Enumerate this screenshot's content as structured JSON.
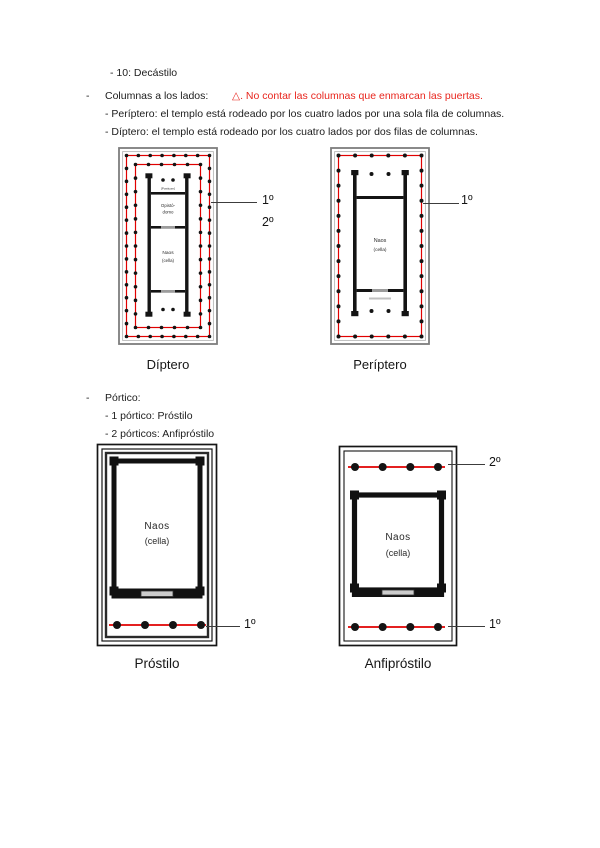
{
  "colors": {
    "warning_red": "#e8251d",
    "diagram_red": "#e10000",
    "ink": "#1c1c1c"
  },
  "notes": {
    "line1": "- 10: Decástilo",
    "bullet": "-",
    "columns_label": "Columnas a los lados:",
    "warning": "△. No contar las columnas que enmarcan las puertas.",
    "periptero_def": "- Períptero: el templo está rodeado por los cuatro lados por una sola fila de columnas.",
    "diptero_def": "- Díptero: el templo está rodeado por los cuatro lados por dos filas de columnas."
  },
  "portico": {
    "bullet": "-",
    "title": "Pórtico:",
    "item1": "- 1 pórtico: Próstilo",
    "item2": "- 2 pórticos: Anfipróstilo"
  },
  "diagrams": {
    "diptero": {
      "caption": "Díptero",
      "posticum_label": "[Posticum]",
      "opistodomo_line1": "Opistó-",
      "opistodomo_line2": "domo",
      "naos_line1": "Naos",
      "naos_line2": "(cella)",
      "annotation_1": "1º",
      "annotation_2": "2º",
      "outer_short_side_columns": 8,
      "outer_long_side_columns": 15,
      "inner_short_side_columns": 6,
      "inner_long_side_columns": 13,
      "porch_columns": 2
    },
    "periptero": {
      "caption": "Períptero",
      "naos_line1": "Naos",
      "naos_line2": "(cella)",
      "annotation_1": "1º",
      "short_side_columns": 6,
      "long_side_columns": 13,
      "porch_columns": 2
    },
    "prostilo": {
      "caption": "Próstilo",
      "naos_line1": "Naos",
      "naos_line2": "(cella)",
      "annotation_1": "1º",
      "porch_columns": 4
    },
    "anfiprostilo": {
      "caption": "Anfipróstilo",
      "naos_line1": "Naos",
      "naos_line2": "(cella)",
      "annotation_top": "2º",
      "annotation_bottom": "1º",
      "porch_columns": 4
    }
  }
}
